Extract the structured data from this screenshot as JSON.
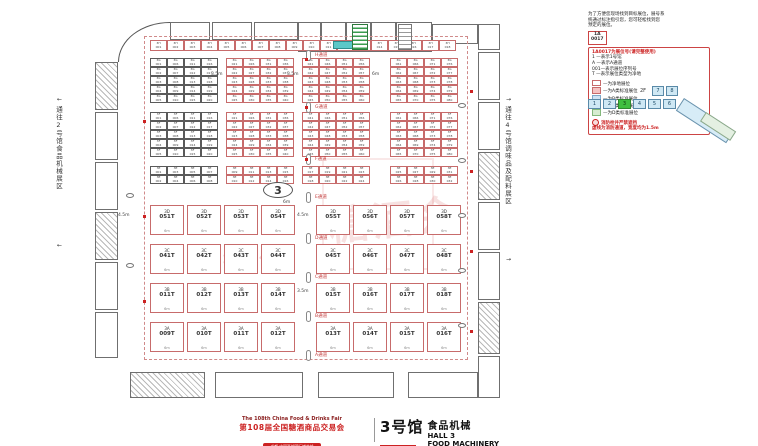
{
  "legend": {
    "intro": [
      "为了方便您现场找到目标展位，展号系",
      "统通过标注指引您，您可轻松找到您",
      "预定的展位。"
    ],
    "sample": {
      "top": "1A",
      "bottom": "0017"
    },
    "sample_note": "1A0017为展位号(请完整使用)",
    "code_lines": [
      "1 —表示1号馆",
      "A —表示A通道",
      "001—表示展位序列号",
      "T —表示展位类型为净地"
    ],
    "swatches": [
      {
        "color": "#ffffff",
        "border": "#c76b6b",
        "label": "—为净地展位"
      },
      {
        "color": "#f5c2c2",
        "border": "#c76b6b",
        "label": "—为A类标准展位"
      },
      {
        "color": "#cfe3f5",
        "border": "#7fa8c9",
        "label": "—为B类标准展位"
      },
      {
        "color": "#f8edc0",
        "border": "#c9ae5a",
        "label": "—为C类标准展位"
      },
      {
        "color": "#d6ecd0",
        "border": "#84b87c",
        "label": "—为D类标准展位"
      }
    ],
    "fire_note": "消防栓并严禁遮挡",
    "lane_note": "虚线为消防通道，宽度均为1.5m"
  },
  "minimap": {
    "floor2_label": "2F",
    "floor2_tabs": [
      "7",
      "8"
    ],
    "floor1_tabs": [
      "1",
      "2",
      "3",
      "4",
      "5",
      "6"
    ],
    "active_tab": "3"
  },
  "plan": {
    "hall_marker": "3",
    "left_corridor": "通往2号馆食品机械展区",
    "right_corridor": "通往4号馆调味品及配料展区",
    "arrow_left": "←",
    "arrow_right": "→",
    "watermark_main": "糖酒会",
    "watermark_sub": "净地展位图",
    "top_row": {
      "prefix": "3H",
      "start": 1,
      "count": 18
    },
    "upper_bands": [
      {
        "prefix": "3G",
        "rows": 5
      },
      {
        "prefix": "3F",
        "rows": 5
      },
      {
        "prefix": "3E",
        "rows": 2
      }
    ],
    "aisles": [
      "H通道",
      "G通道",
      "F通道",
      "E通道",
      "D通道",
      "C通道",
      "B通道",
      "A通道"
    ],
    "lower_bands": [
      {
        "booths": [
          "3D051T",
          "3D052T",
          "3D053T",
          "3D054T",
          "3D055T",
          "3D056T",
          "3D057T",
          "3D058T"
        ]
      },
      {
        "booths": [
          "3C041T",
          "3C042T",
          "3C043T",
          "3C044T",
          "3C045T",
          "3C046T",
          "3C047T",
          "3C048T"
        ]
      },
      {
        "booths": [
          "3B011T",
          "3B012T",
          "3B013T",
          "3B014T",
          "3B015T",
          "3B016T",
          "3B017T",
          "3B018T"
        ]
      },
      {
        "booths": [
          "3A009T",
          "3A010T",
          "3A011T",
          "3A012T",
          "3A013T",
          "3A014T",
          "3A015T",
          "3A016T"
        ]
      }
    ],
    "booth_width_dim": "6m",
    "dim_labels": [
      {
        "t": "3.5m",
        "x": 211,
        "y": 72
      },
      {
        "t": "3.5m",
        "x": 287,
        "y": 72
      },
      {
        "t": "6m",
        "x": 372,
        "y": 72
      },
      {
        "t": "4.5m",
        "x": 118,
        "y": 213
      },
      {
        "t": "4.5m",
        "x": 297,
        "y": 213
      },
      {
        "t": "3.5m",
        "x": 297,
        "y": 289
      },
      {
        "t": "6m",
        "x": 283,
        "y": 200
      }
    ]
  },
  "footer": {
    "fair_en": "The 108th China Food & Drinks Fair",
    "fair_cn": "第108届全国糖酒商品交易会",
    "fair_sub": "成都·中国西部国际博览城",
    "badge": "展位示意图",
    "hall_cn": "3号馆",
    "hall_category": "食品机械",
    "hall_en": "HALL 3",
    "hall_en2": "FOOD MACHINERY"
  }
}
